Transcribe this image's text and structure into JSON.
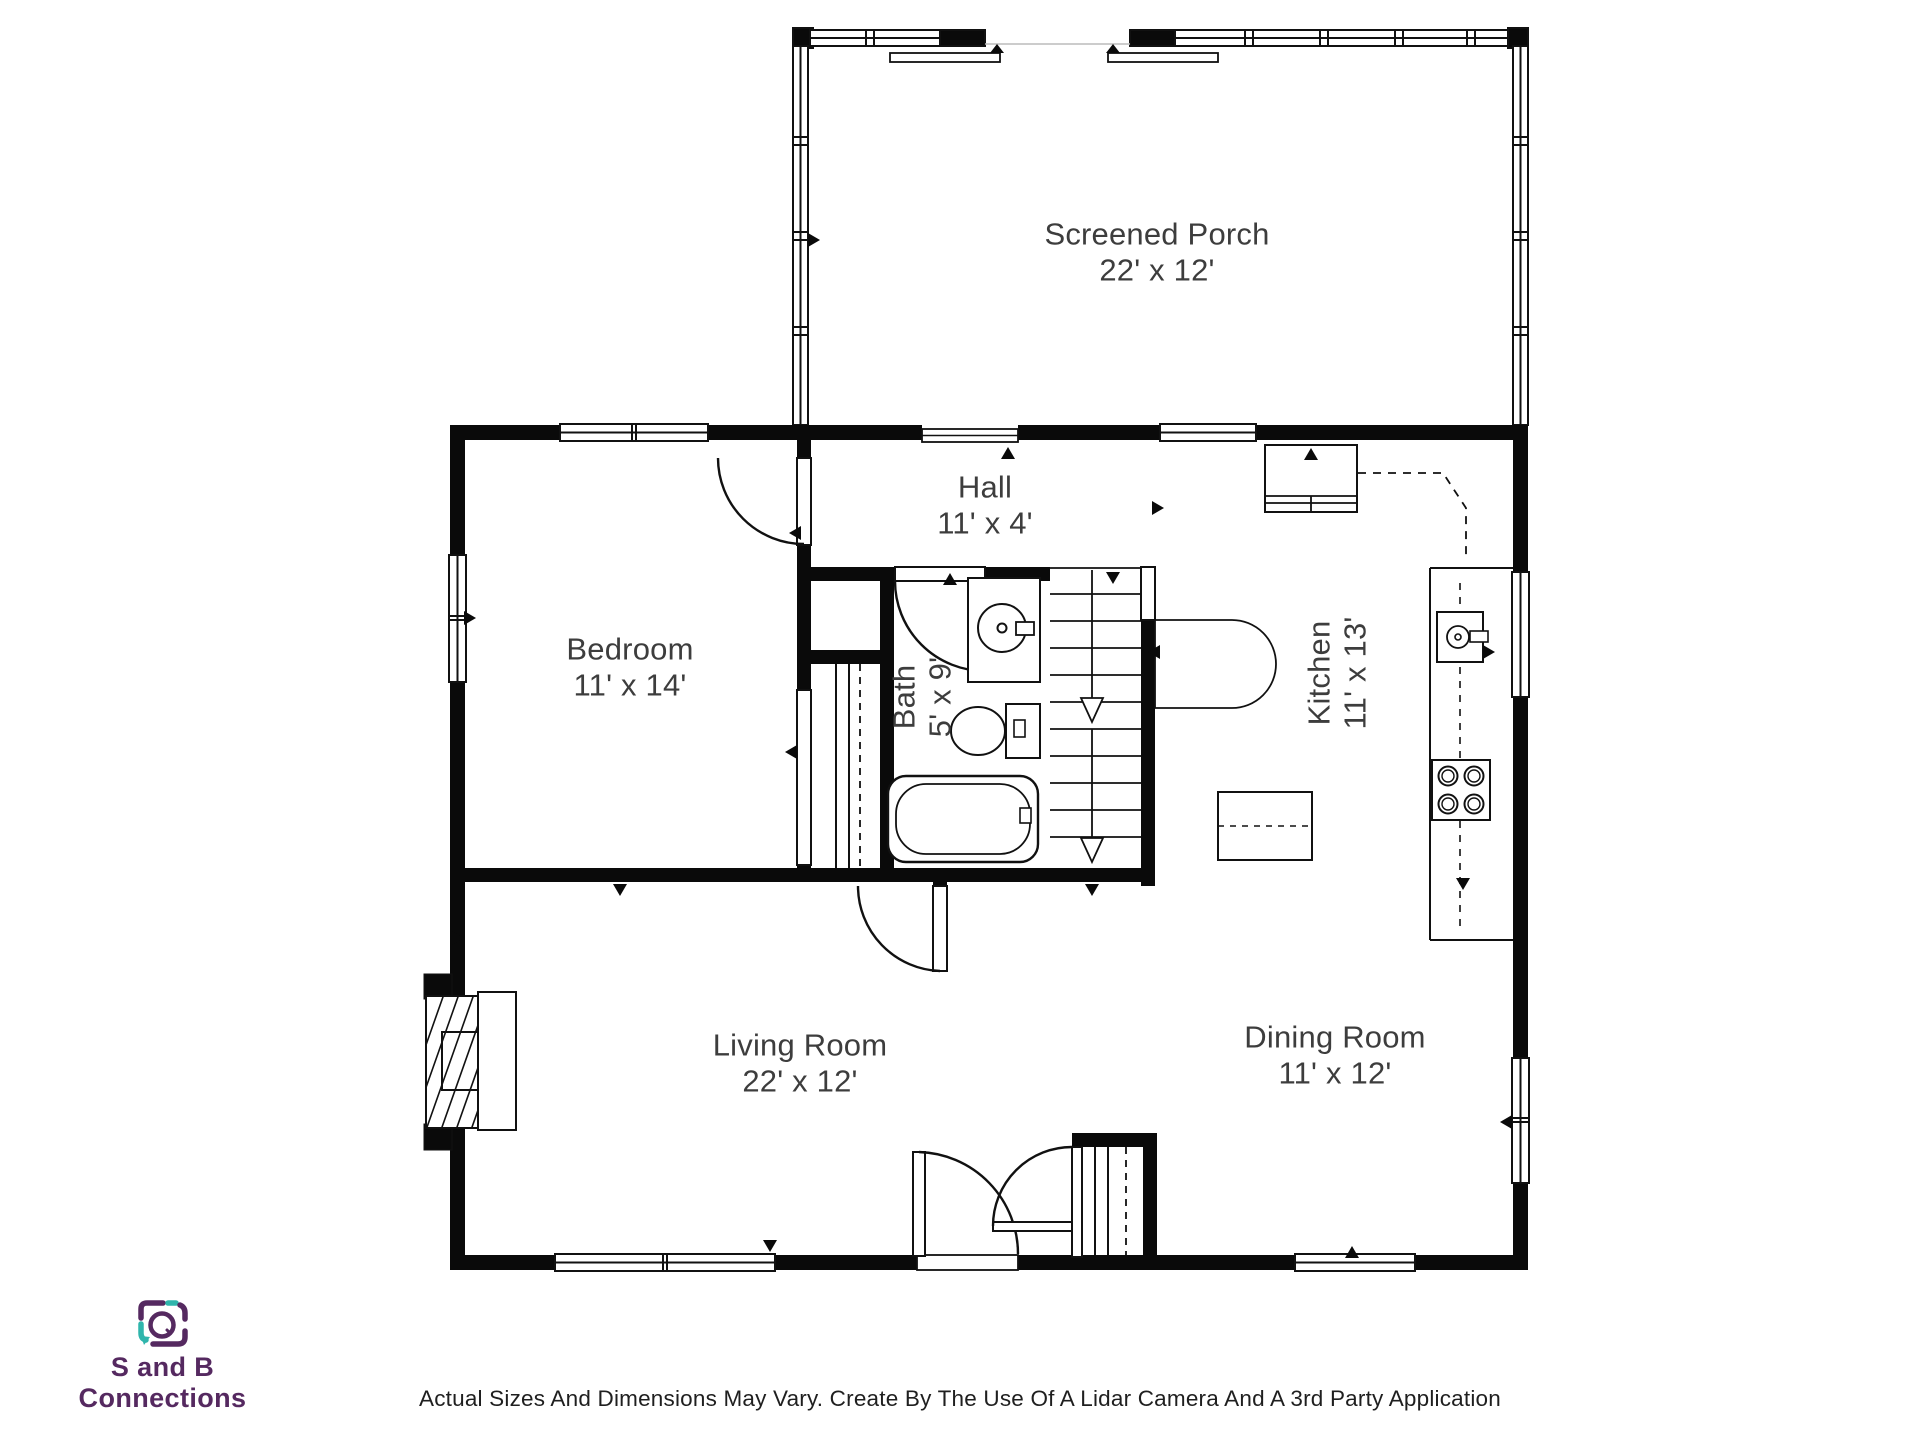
{
  "floorplan": {
    "rooms": [
      {
        "name": "Screened Porch",
        "dims": "22' x 12'"
      },
      {
        "name": "Hall",
        "dims": "11' x 4'"
      },
      {
        "name": "Bedroom",
        "dims": "11' x 14'"
      },
      {
        "name": "Bath",
        "dims": "5' x 9'"
      },
      {
        "name": "Kitchen",
        "dims": "11' x 13'"
      },
      {
        "name": "Living Room",
        "dims": "22' x 12'"
      },
      {
        "name": "Dining Room",
        "dims": "11' x 12'"
      }
    ],
    "wall_color": "#0a0a0a",
    "line_color": "#111111",
    "label_color": "#3d3d3d"
  },
  "branding": {
    "logo_text": "S and B Connections",
    "purple": "#552960",
    "teal": "#2fb5ac"
  },
  "footer": {
    "disclaimer": "Actual Sizes And Dimensions May Vary. Create By The Use Of A Lidar Camera And A 3rd Party Application"
  }
}
